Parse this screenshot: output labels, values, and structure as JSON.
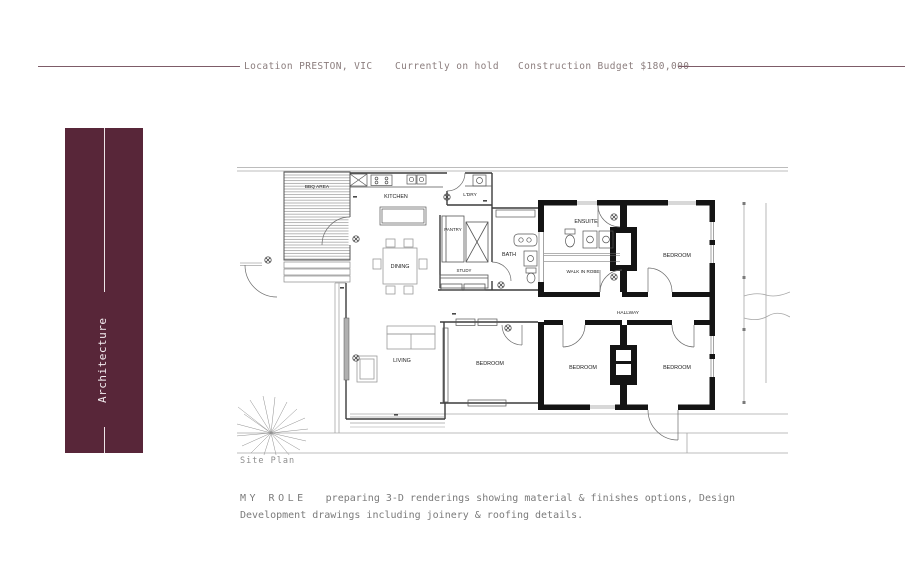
{
  "header": {
    "location": "Location PRESTON, VIC",
    "status": "Currently on hold",
    "budget": "Construction Budget $180,000"
  },
  "sidebar": {
    "label": "Architecture"
  },
  "plan": {
    "caption": "Site Plan",
    "rooms": {
      "bbq": "BBQ AREA",
      "kitchen": "KITCHEN",
      "laundry": "L'DRY",
      "pantry": "PANTRY",
      "bath": "BATH",
      "study": "STUDY",
      "dining": "DINING",
      "living": "LIVING",
      "ensuite": "ENSUITE",
      "walk_in_robe": "WALK IN ROBE",
      "hallway": "HALLWAY",
      "bedroom_ne": "BEDROOM",
      "bedroom_ext": "BEDROOM",
      "bedroom_s_mid": "BEDROOM",
      "bedroom_s_east": "BEDROOM"
    }
  },
  "role": {
    "heading": "MY ROLE",
    "description": "preparing 3-D renderings showing material & finishes options, Design Development drawings including joinery & roofing details."
  },
  "colors": {
    "accent_burgundy": "#582639",
    "header_rule": "#7d5c68",
    "header_text": "#8b7d7d",
    "body_text": "#7b7b7b"
  }
}
